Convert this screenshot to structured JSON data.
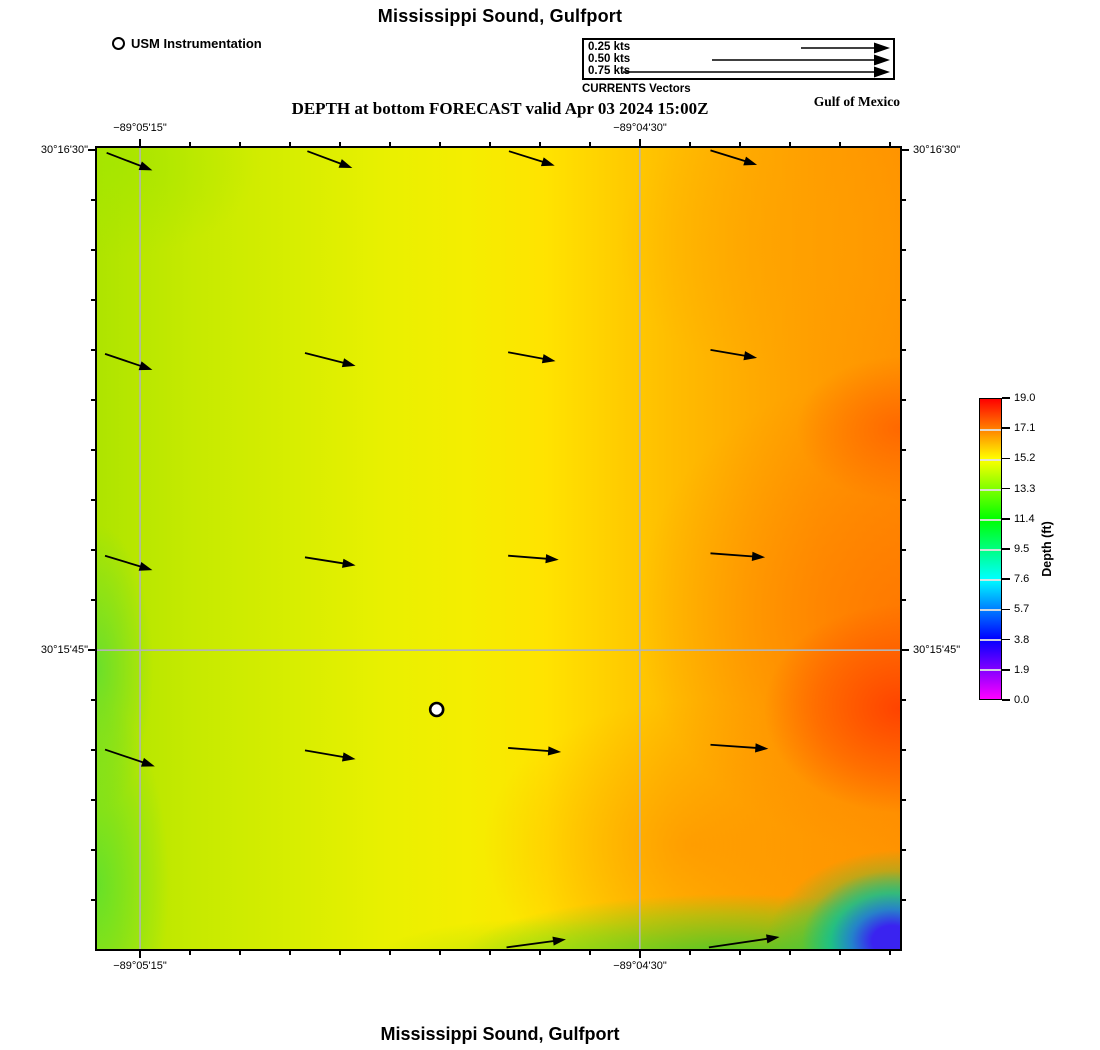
{
  "header": {
    "title": "Mississippi Sound, Gulfport",
    "subtitle": "DEPTH at bottom FORECAST valid Apr 03 2024 15:00Z",
    "station_legend": {
      "label": "USM Instrumentation"
    },
    "vector_legend": {
      "rows": [
        {
          "label": "0.25 kts"
        },
        {
          "label": "0.50 kts"
        },
        {
          "label": "0.75 kts"
        }
      ],
      "caption": "CURRENTS Vectors"
    },
    "region_label": "Gulf of Mexico"
  },
  "axes": {
    "top": [
      "−89°05'15\"",
      "−89°04'30\""
    ],
    "bottom": [
      "−89°05'15\"",
      "−89°04'30\""
    ],
    "left": [
      "30°16'30\"",
      "30°15'45\""
    ],
    "right": [
      "30°16'30\"",
      "30°15'45\""
    ]
  },
  "colorbar": {
    "label": "Depth (ft)",
    "tick_labels": [
      "19.0",
      "17.1",
      "15.2",
      "13.3",
      "11.4",
      "9.5",
      "7.6",
      "5.7",
      "3.8",
      "1.9",
      "0.0"
    ]
  },
  "footer": {
    "title": "Mississippi Sound, Gulfport"
  },
  "chart_data": {
    "type": "heatmap",
    "title": "Mississippi Sound, Gulfport",
    "subtitle": "DEPTH at bottom FORECAST valid Apr 03 2024 15:00Z",
    "variable": "Depth (ft)",
    "region": "Gulf of Mexico",
    "colormap": {
      "name": "rainbow",
      "stops": [
        {
          "value": 0.0,
          "color": "#ff00ff"
        },
        {
          "value": 3.8,
          "color": "#0000ff"
        },
        {
          "value": 7.6,
          "color": "#00ffff"
        },
        {
          "value": 11.4,
          "color": "#00ff00"
        },
        {
          "value": 15.2,
          "color": "#ffff00"
        },
        {
          "value": 19.0,
          "color": "#ff0000"
        }
      ]
    },
    "colorbar_ticks": [
      19.0,
      17.1,
      15.2,
      13.3,
      11.4,
      9.5,
      7.6,
      5.7,
      3.8,
      1.9,
      0.0
    ],
    "x_axis": {
      "type": "longitude",
      "tick_labels": [
        "−89°05'15\"",
        "−89°04'30\""
      ],
      "tick_fractions": [
        0.0536,
        0.676
      ]
    },
    "y_axis": {
      "type": "latitude",
      "tick_labels": [
        "30°16'30\"",
        "30°15'45\""
      ],
      "tick_fractions": [
        0.0025,
        0.627
      ]
    },
    "gridline_color": "#b4b4b4",
    "station": {
      "label": "USM Instrumentation",
      "fx": 0.423,
      "fy": 0.701
    },
    "current_vectors": {
      "unit": "kts",
      "legend_speeds": [
        0.25,
        0.5,
        0.75
      ],
      "arrows": [
        [
          0.012,
          0.006,
          0.069,
          0.028
        ],
        [
          0.262,
          0.004,
          0.318,
          0.025
        ],
        [
          0.513,
          0.004,
          0.57,
          0.022
        ],
        [
          0.764,
          0.003,
          0.822,
          0.021
        ],
        [
          0.01,
          0.257,
          0.069,
          0.277
        ],
        [
          0.259,
          0.256,
          0.322,
          0.272
        ],
        [
          0.512,
          0.255,
          0.571,
          0.266
        ],
        [
          0.764,
          0.252,
          0.822,
          0.262
        ],
        [
          0.01,
          0.509,
          0.069,
          0.527
        ],
        [
          0.259,
          0.511,
          0.322,
          0.521
        ],
        [
          0.512,
          0.509,
          0.575,
          0.514
        ],
        [
          0.764,
          0.506,
          0.832,
          0.511
        ],
        [
          0.01,
          0.751,
          0.072,
          0.772
        ],
        [
          0.259,
          0.752,
          0.322,
          0.763
        ],
        [
          0.512,
          0.749,
          0.578,
          0.754
        ],
        [
          0.764,
          0.745,
          0.836,
          0.75
        ],
        [
          0.51,
          0.998,
          0.584,
          0.988
        ],
        [
          0.762,
          0.998,
          0.85,
          0.985
        ]
      ]
    },
    "depth_field_summary": [
      {
        "area": "west side",
        "approx_depth_ft": 14.0
      },
      {
        "area": "center",
        "approx_depth_ft": 15.2
      },
      {
        "area": "east side",
        "approx_depth_ft": 17.5
      },
      {
        "area": "east edge hotspot",
        "approx_depth_ft": 18.5
      },
      {
        "area": "south edge band",
        "approx_depth_ft": 11.5
      },
      {
        "area": "southeast corner",
        "approx_depth_ft": 4.0
      }
    ]
  }
}
